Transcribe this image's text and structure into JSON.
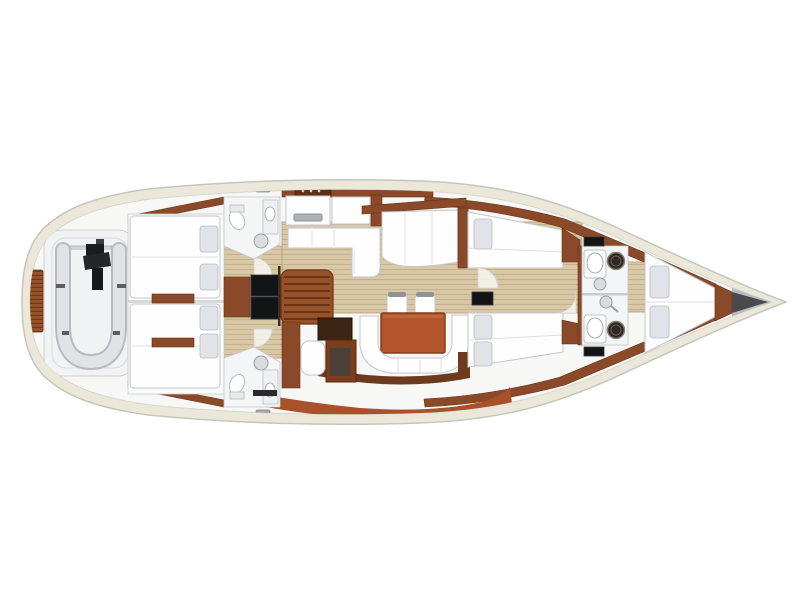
{
  "plan": {
    "type": "sailing-yacht-interior-floor-plan",
    "view": "top-down",
    "orientation": "bow-right",
    "areas": [
      "swim-platform",
      "transom-teak-grate",
      "tender-garage",
      "dinghy-with-outboard",
      "aft-cabin-port",
      "aft-cabin-starboard",
      "aft-head-port",
      "aft-head-starboard",
      "companionway-stairs",
      "engine-compartment",
      "galley",
      "salon-settee",
      "salon-table",
      "salon-chairs",
      "salon-sofa",
      "nav-station",
      "mid-cabin-port",
      "mid-cabin-starboard",
      "forward-head-port",
      "forward-head-starboard",
      "v-berth",
      "anchor-locker",
      "bow"
    ]
  },
  "colors": {
    "background": "#ffffff",
    "hull_deck": "#ece8d9",
    "hull_outline": "#c6c5bd",
    "hull_interior": "#f7f7f6",
    "interior_line": "#d9d7cd",
    "white_furniture": "#fefefe",
    "furniture_outline": "#c4c6c9",
    "room_white": "#f4f5f6",
    "pillow": "#e2e3e9",
    "pillow_outline": "#b7bac1",
    "teak": "#d8c8a5",
    "teak_stripe": "#c4b08a",
    "teak_border": "#b59a72",
    "wood_dark": "#6e3a1e",
    "wood": "#8a4a29",
    "wood_light": "#97522a",
    "wood_line": "#6a3315",
    "terracotta": "#a8512a",
    "table": "#b2552d",
    "table_edge": "#8a3c1a",
    "black": "#131416",
    "dark_panel": "#3d2413",
    "gray_fixture": "#d9dbdd",
    "fixture_line": "#9b9ea1",
    "dark_circle": "#2e2722",
    "dinghy_tube": "#e0e2e5",
    "dinghy_outline": "#b7bbc0",
    "dinghy_floor": "#f1f2f4",
    "motor_black": "#1b1c1e",
    "hatch_gray": "#a7a9ad",
    "seat_back": "#8f9397",
    "anchor_dark": "#4a4a4c",
    "anchor_gray": "#b9bcbe"
  }
}
